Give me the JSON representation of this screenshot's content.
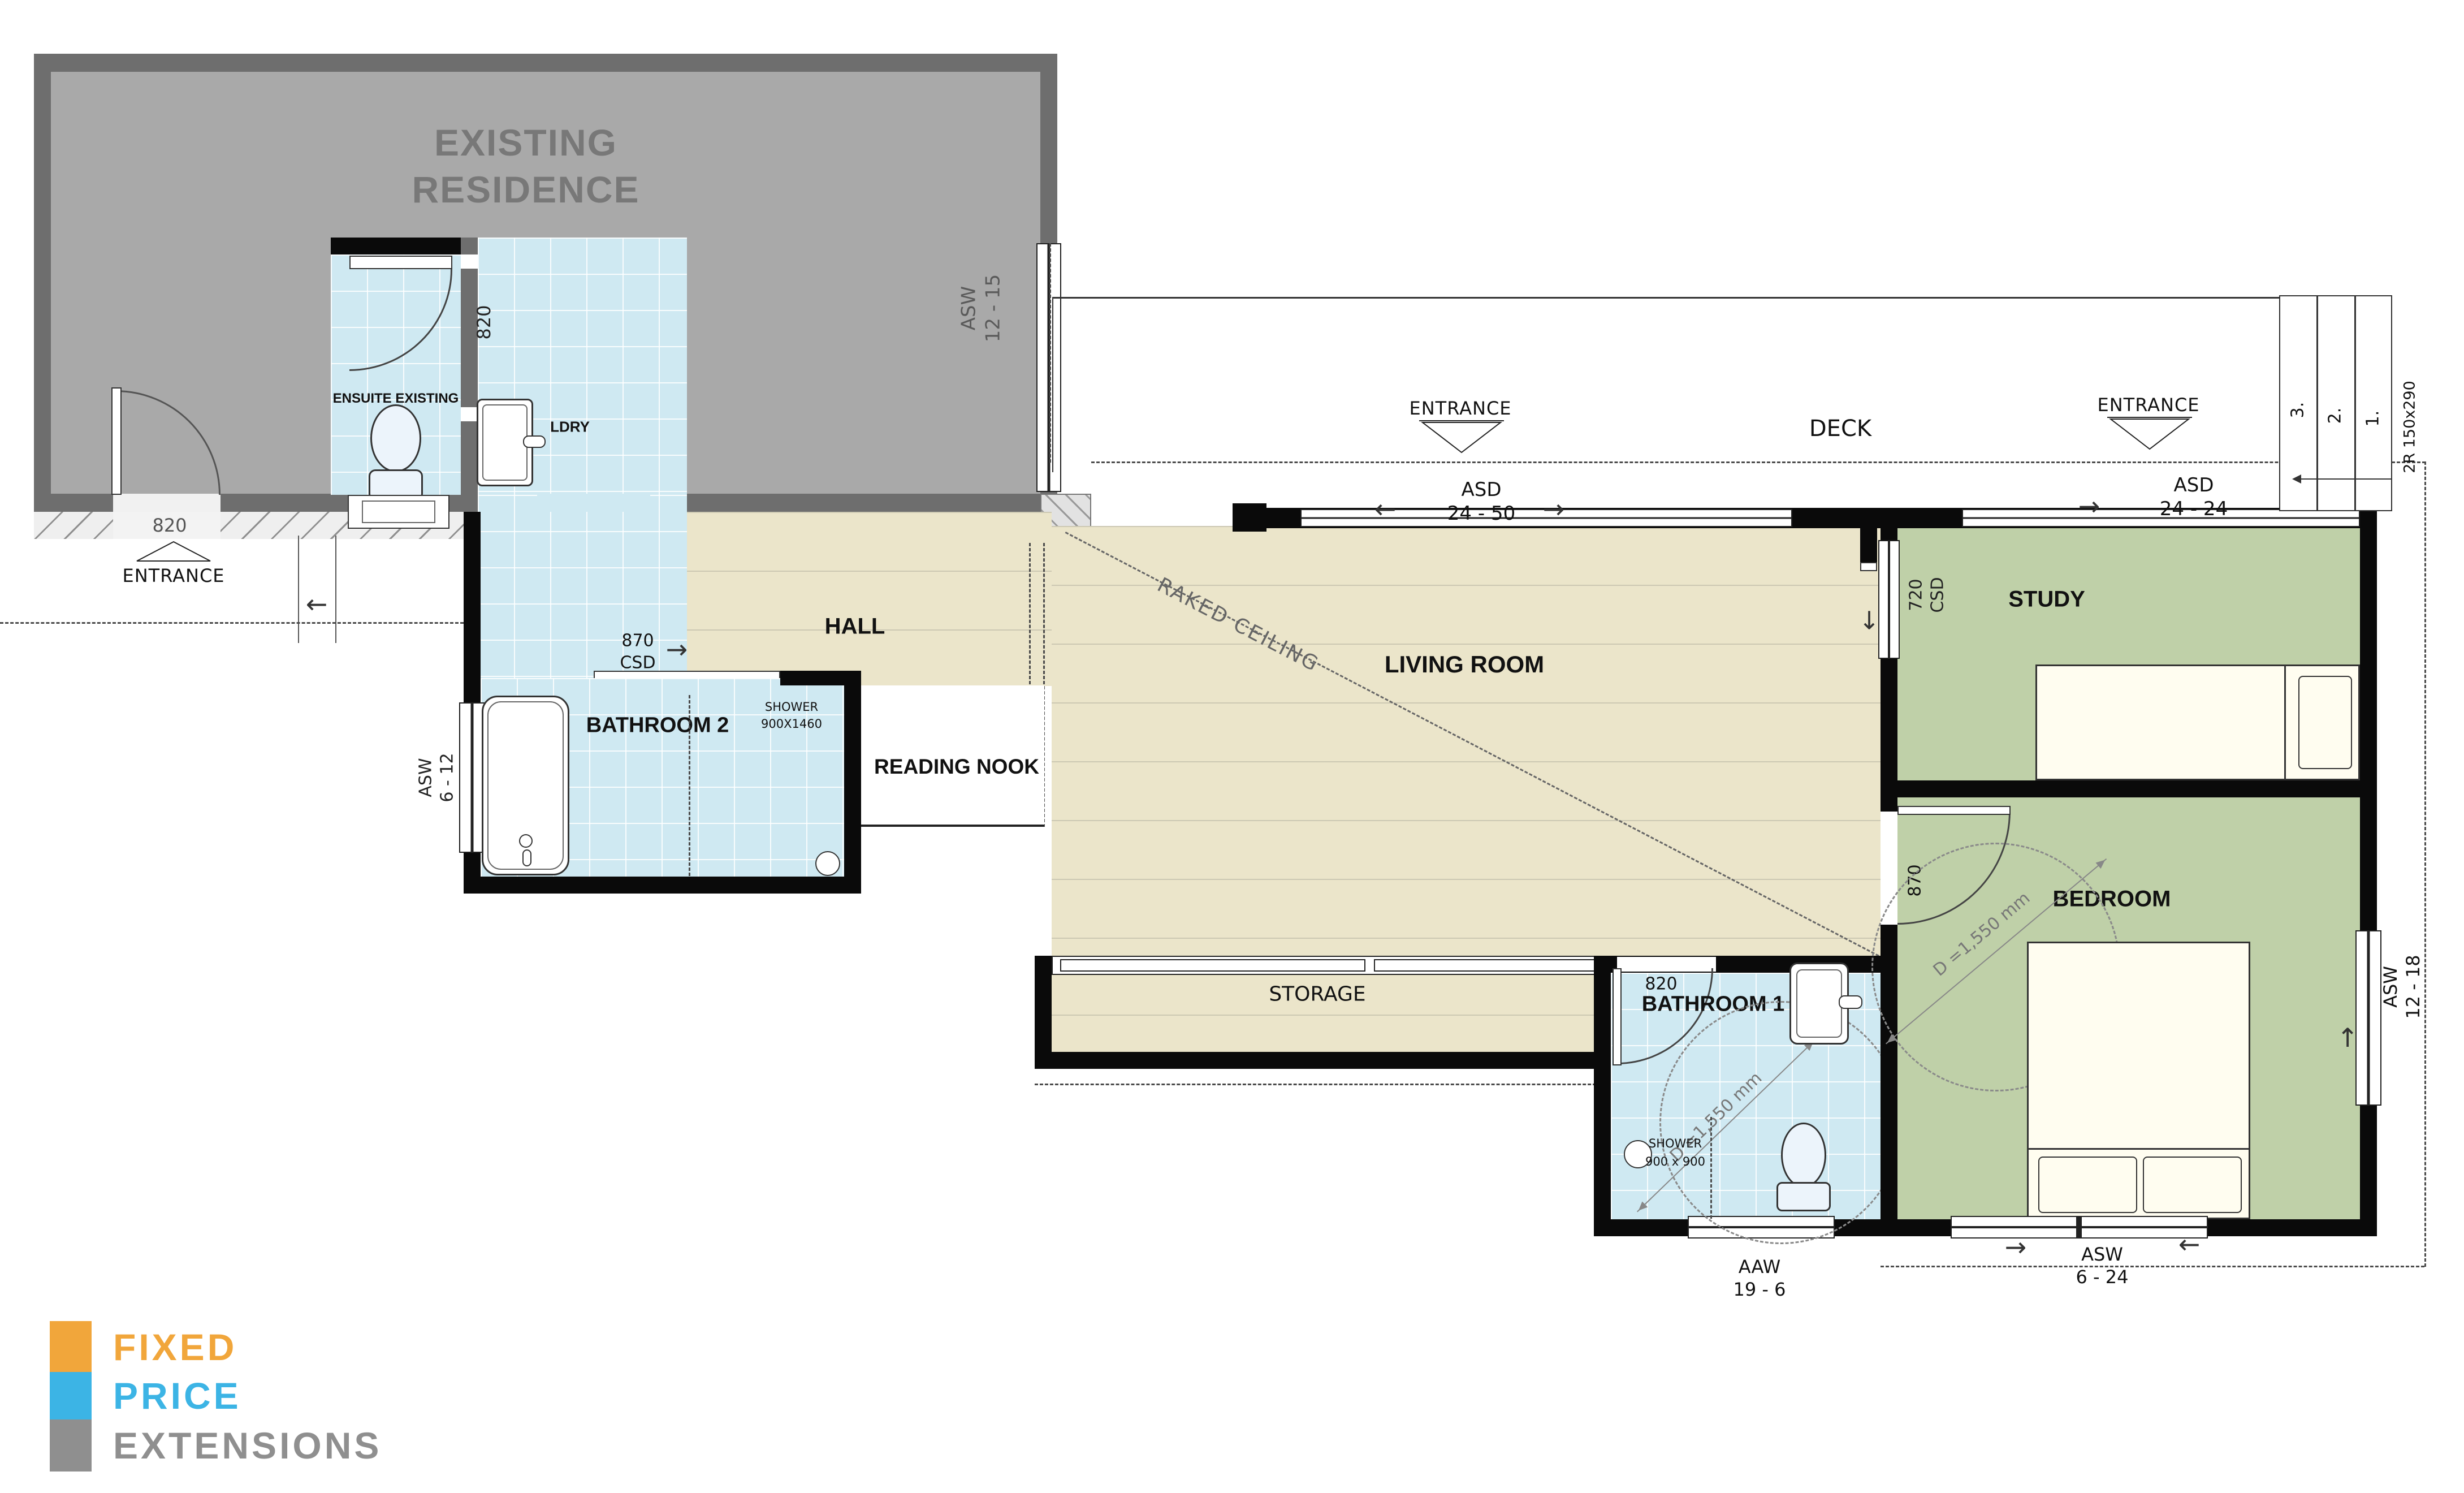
{
  "colors": {
    "existing_fill": "#a9a9a9",
    "existing_wall": "#6e6e6e",
    "tile_blue": "#cfe9f2",
    "floor_beige": "#ebe5ca",
    "room_green": "#bfd0a8",
    "wall_black": "#0a0a0a",
    "logo_orange": "#F1A63B",
    "logo_blue": "#3CB4E5",
    "logo_gray": "#8F8F8F"
  },
  "existing_residence": {
    "title_line1": "EXISTING",
    "title_line2": "RESIDENCE",
    "ensuite_label": "ENSUITE EXISTING",
    "ldry_label": "LDRY",
    "ensuite_door_dim": "820",
    "window_label_line1": "ASW",
    "window_label_line2": "12 - 15"
  },
  "entrance_left": {
    "dim": "820",
    "label": "ENTRANCE"
  },
  "hall": {
    "label": "HALL",
    "csd_dim_line1": "870",
    "csd_dim_line2": "CSD"
  },
  "bathroom2": {
    "label": "BATHROOM 2",
    "shower_line1": "SHOWER",
    "shower_line2": "900X1460",
    "window_label_line1": "ASW",
    "window_label_line2": "6 - 12"
  },
  "reading_nook": {
    "label": "READING NOOK"
  },
  "living_room": {
    "label": "LIVING ROOM",
    "raked_ceiling": "RAKED CEILING"
  },
  "storage": {
    "label": "STORAGE"
  },
  "deck": {
    "label": "DECK",
    "entrance_mid_label": "ENTRANCE",
    "asd_mid_line1": "ASD",
    "asd_mid_line2": "24 - 50",
    "entrance_right_label": "ENTRANCE",
    "asd_right_line1": "ASD",
    "asd_right_line2": "24 - 24",
    "step_3": "3.",
    "step_2": "2.",
    "step_1": "1.",
    "riser_label": "2R 150x290"
  },
  "study": {
    "label": "STUDY",
    "csd_line1": "720",
    "csd_line2": "CSD"
  },
  "bedroom": {
    "label": "BEDROOM",
    "door_dim": "870",
    "diameter_label": "D =1,550 mm",
    "window_right_line1": "ASW",
    "window_right_line2": "12 - 18",
    "window_bottom_line1": "ASW",
    "window_bottom_line2": "6 - 24"
  },
  "bathroom1": {
    "label": "BATHROOM 1",
    "door_dim": "820",
    "diameter_label": "D =1,550 mm",
    "shower_line1": "SHOWER",
    "shower_line2": "900 x 900",
    "window_line1": "AAW",
    "window_line2": "19 - 6"
  },
  "logo": {
    "line1": "FIXED",
    "line2": "PRICE",
    "line3": "EXTENSIONS"
  },
  "arrows": {
    "left": "←",
    "right": "→",
    "up": "↑",
    "down": "↓"
  }
}
